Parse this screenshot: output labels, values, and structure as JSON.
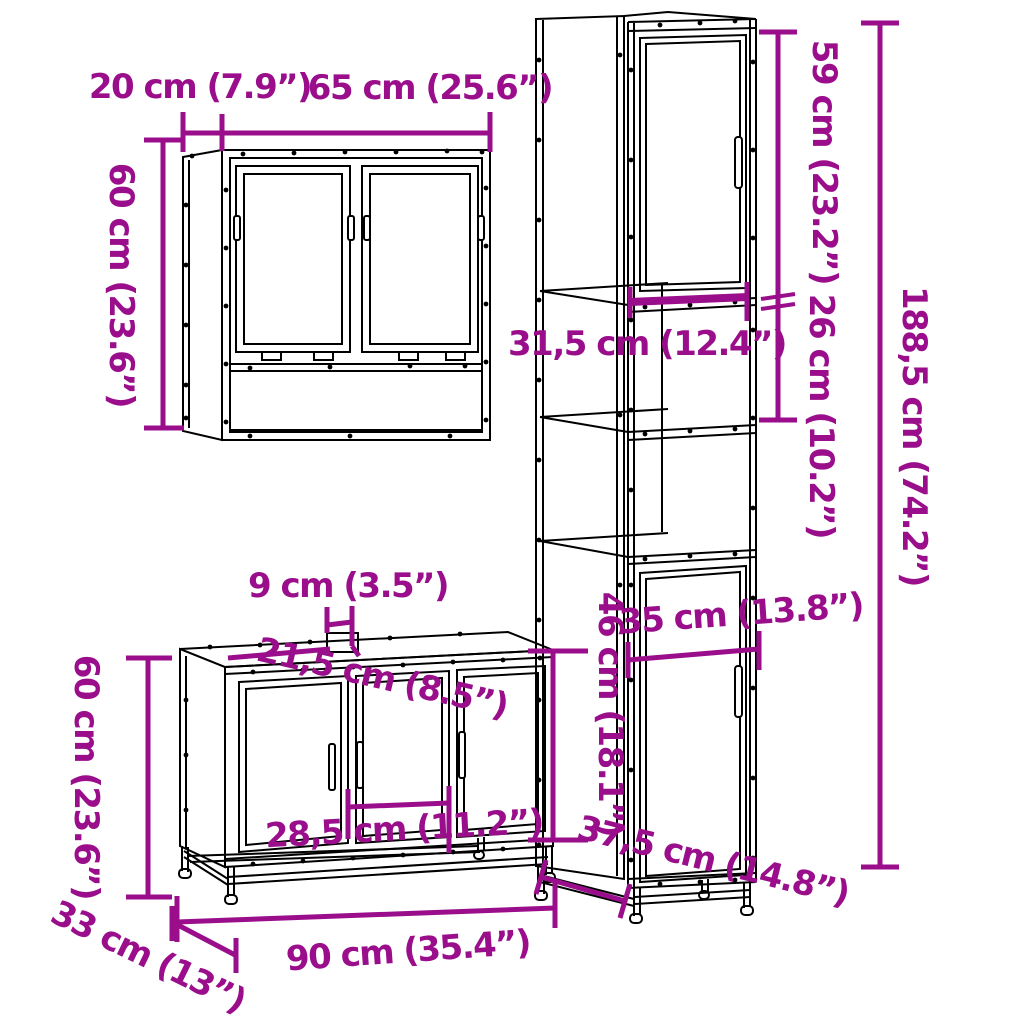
{
  "diagram": {
    "background_color": "#ffffff",
    "drawing_line_color": "#000000",
    "dimension_color": "#9A0E8C",
    "pieces": [
      {
        "name": "mirror-wall-cabinet",
        "dimensions": {
          "depth": "20 cm (7.9”)",
          "width": "65 cm (25.6”)",
          "height": "60 cm (23.6”)"
        }
      },
      {
        "name": "tall-cabinet",
        "dimensions": {
          "upper_door_height": "59 cm (23.2”)",
          "inner_width": "31,5 cm (12.4”)",
          "open_section_height": "26 cm (10.2”)",
          "total_height": "188,5 cm (74.2”)",
          "lower_width": "35 cm (13.8”)",
          "lower_door_height": "46 cm (18.1”)",
          "depth": "37,5 cm (14.8”)"
        }
      },
      {
        "name": "sink-cabinet",
        "dimensions": {
          "tap_gap": "9 cm (3.5”)",
          "top_depth": "21,5 cm (8.5”)",
          "height": "60 cm (23.6”)",
          "middle_door_width": "28,5 cm (11.2”)",
          "depth": "33 cm (13”)",
          "width": "90 cm (35.4”)"
        }
      }
    ]
  }
}
